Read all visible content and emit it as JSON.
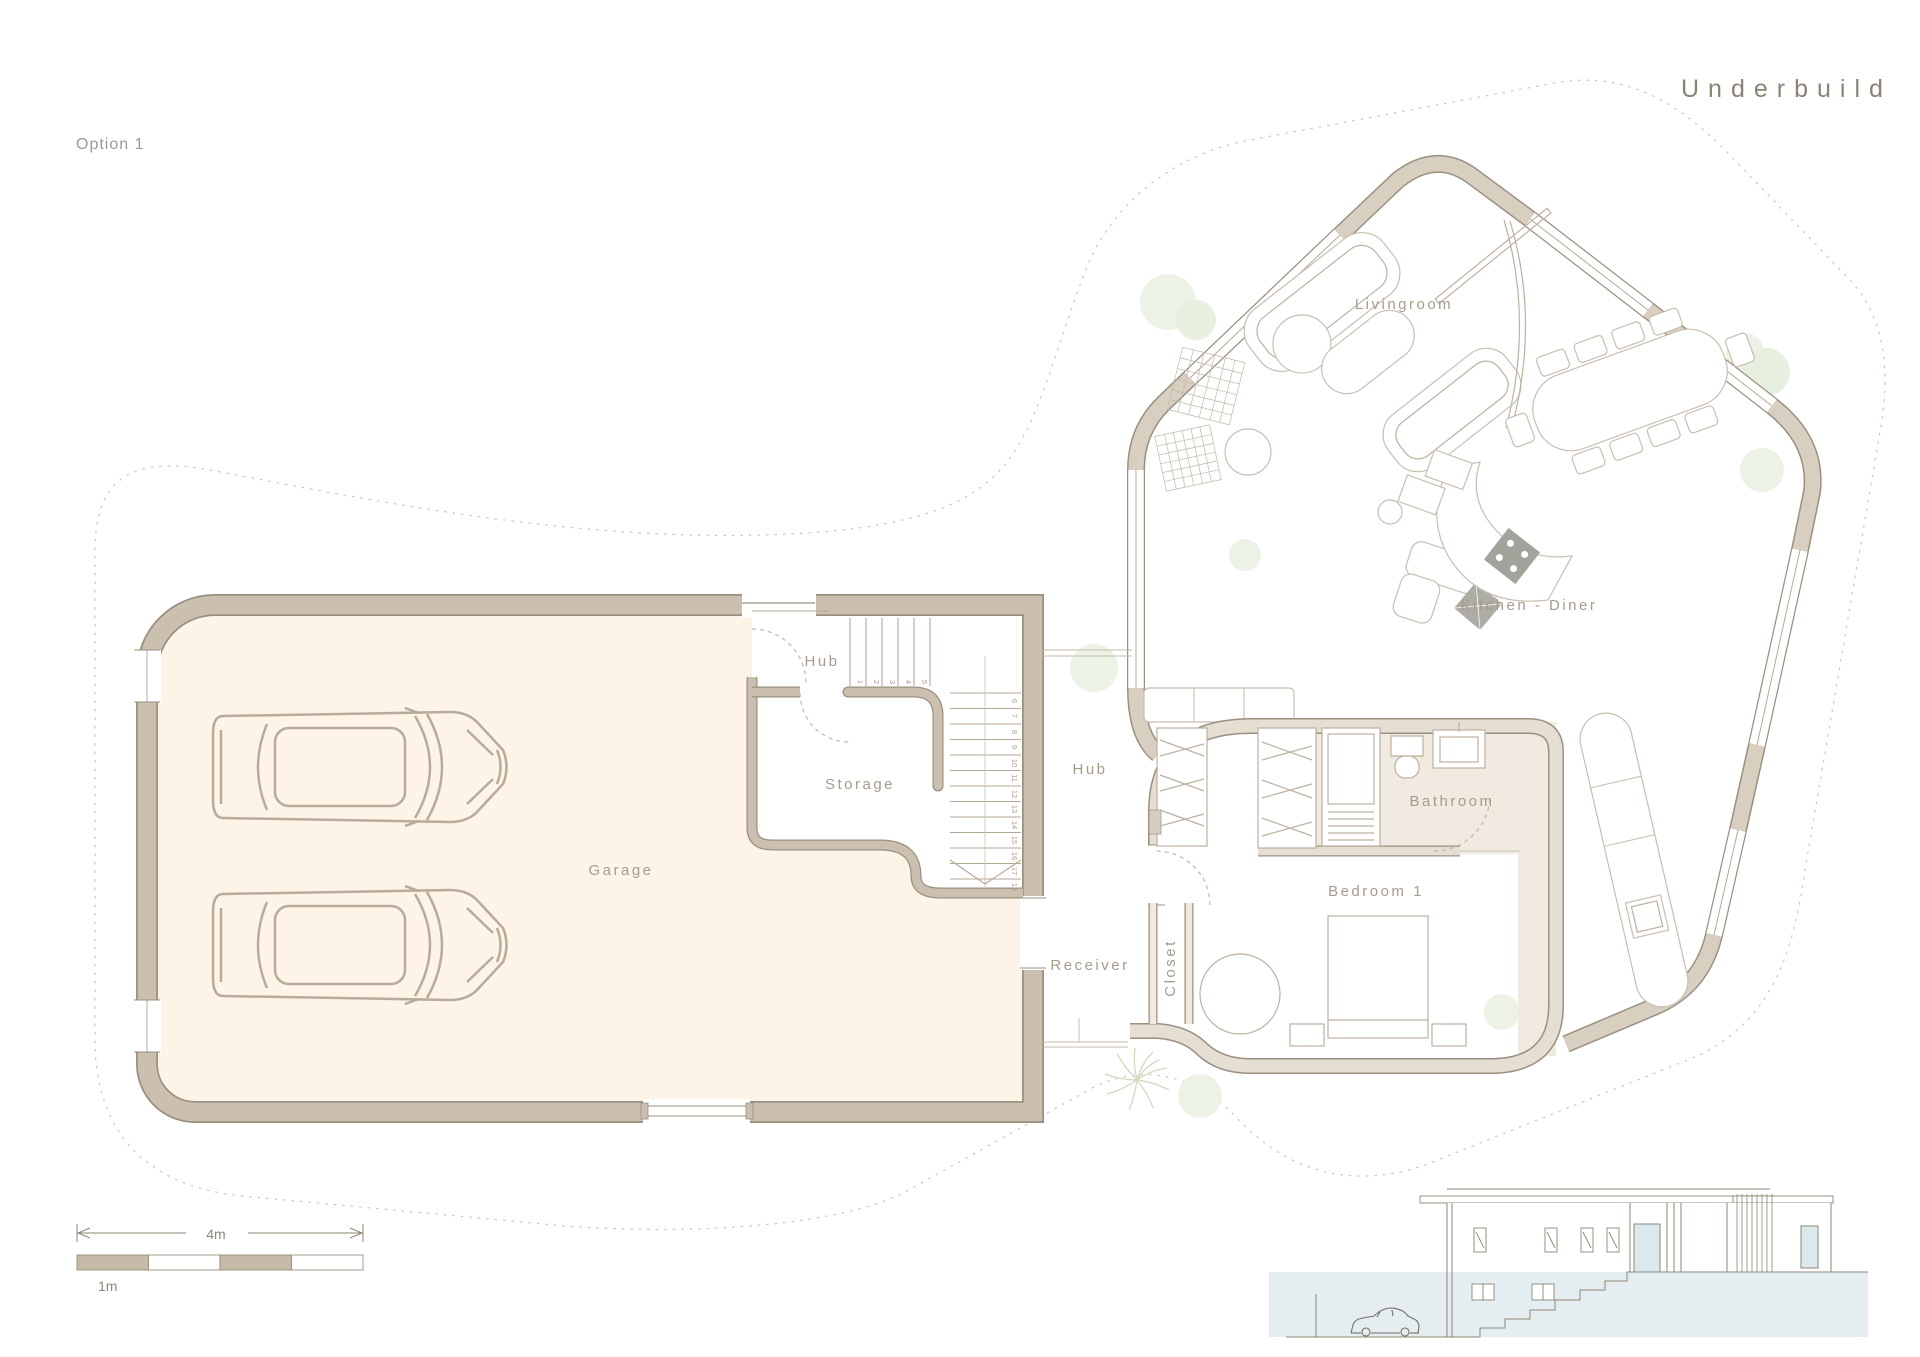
{
  "title": "Underbuild",
  "option_label": "Option 1",
  "rooms": {
    "garage": "Garage",
    "hub": "Hub",
    "storage": "Storage",
    "hub2": "Hub",
    "receiver": "Receiver",
    "closet": "Closet",
    "bedroom": "Bedroom 1",
    "bathroom": "Bathroom",
    "kitchen": "Kitchen - Diner",
    "livingroom": "Livingroom"
  },
  "stairs": {
    "numbers": [
      "1",
      "2",
      "3",
      "4",
      "5",
      "6",
      "7",
      "8",
      "9",
      "10",
      "11",
      "12",
      "13",
      "14",
      "15",
      "16",
      "17",
      "18"
    ]
  },
  "scale_bar": {
    "total": "4m",
    "unit": "1m"
  },
  "colors": {
    "garage_wall": "#cbc0af",
    "wing_wall": "#d8cfc0",
    "bedroom_wall": "#e5ded2",
    "wall_edge": "#9a9080",
    "garage_floor": "#fdf3e7",
    "service_floor": "#f0eae1",
    "elevation_water": "#e4edf0",
    "plant_green": "#e9efe0",
    "label_text": "#a79b8b"
  }
}
